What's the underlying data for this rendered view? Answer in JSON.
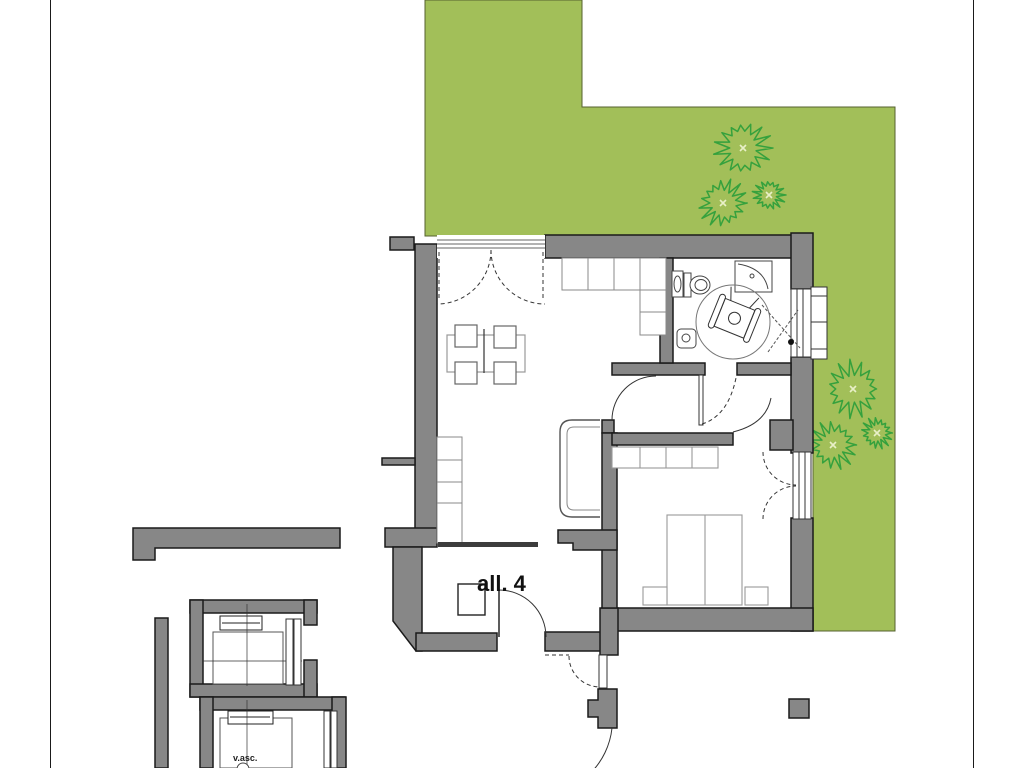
{
  "labels": {
    "apartment": "all. 4",
    "elevator_shaft": "v.asc."
  },
  "colors": {
    "background": "#ffffff",
    "garden": "#a2bf59",
    "garden_edge": "#55622f",
    "wall": "#878787",
    "wall_outline": "#1a1a1a",
    "dark_counter": "#3c3c3c",
    "tree": "#35a13d",
    "tree_center": "#e9f0c8",
    "thin_line": "#333333",
    "furniture_light": "#999999",
    "furniture_mid": "#666666",
    "fixture": "#444444",
    "frame_line": "#1a1a1a",
    "label_text": "#111111"
  },
  "garden": {
    "outline_points": "425,0 582,0 582,107 895,107 895,631 813,631 813,236 425,236",
    "trees": [
      {
        "cx": 743,
        "cy": 148,
        "r": 30
      },
      {
        "cx": 723,
        "cy": 203,
        "r": 26
      },
      {
        "cx": 769,
        "cy": 195,
        "r": 17
      },
      {
        "cx": 853,
        "cy": 389,
        "r": 30
      },
      {
        "cx": 833,
        "cy": 445,
        "r": 26
      },
      {
        "cx": 877,
        "cy": 433,
        "r": 17
      }
    ]
  }
}
